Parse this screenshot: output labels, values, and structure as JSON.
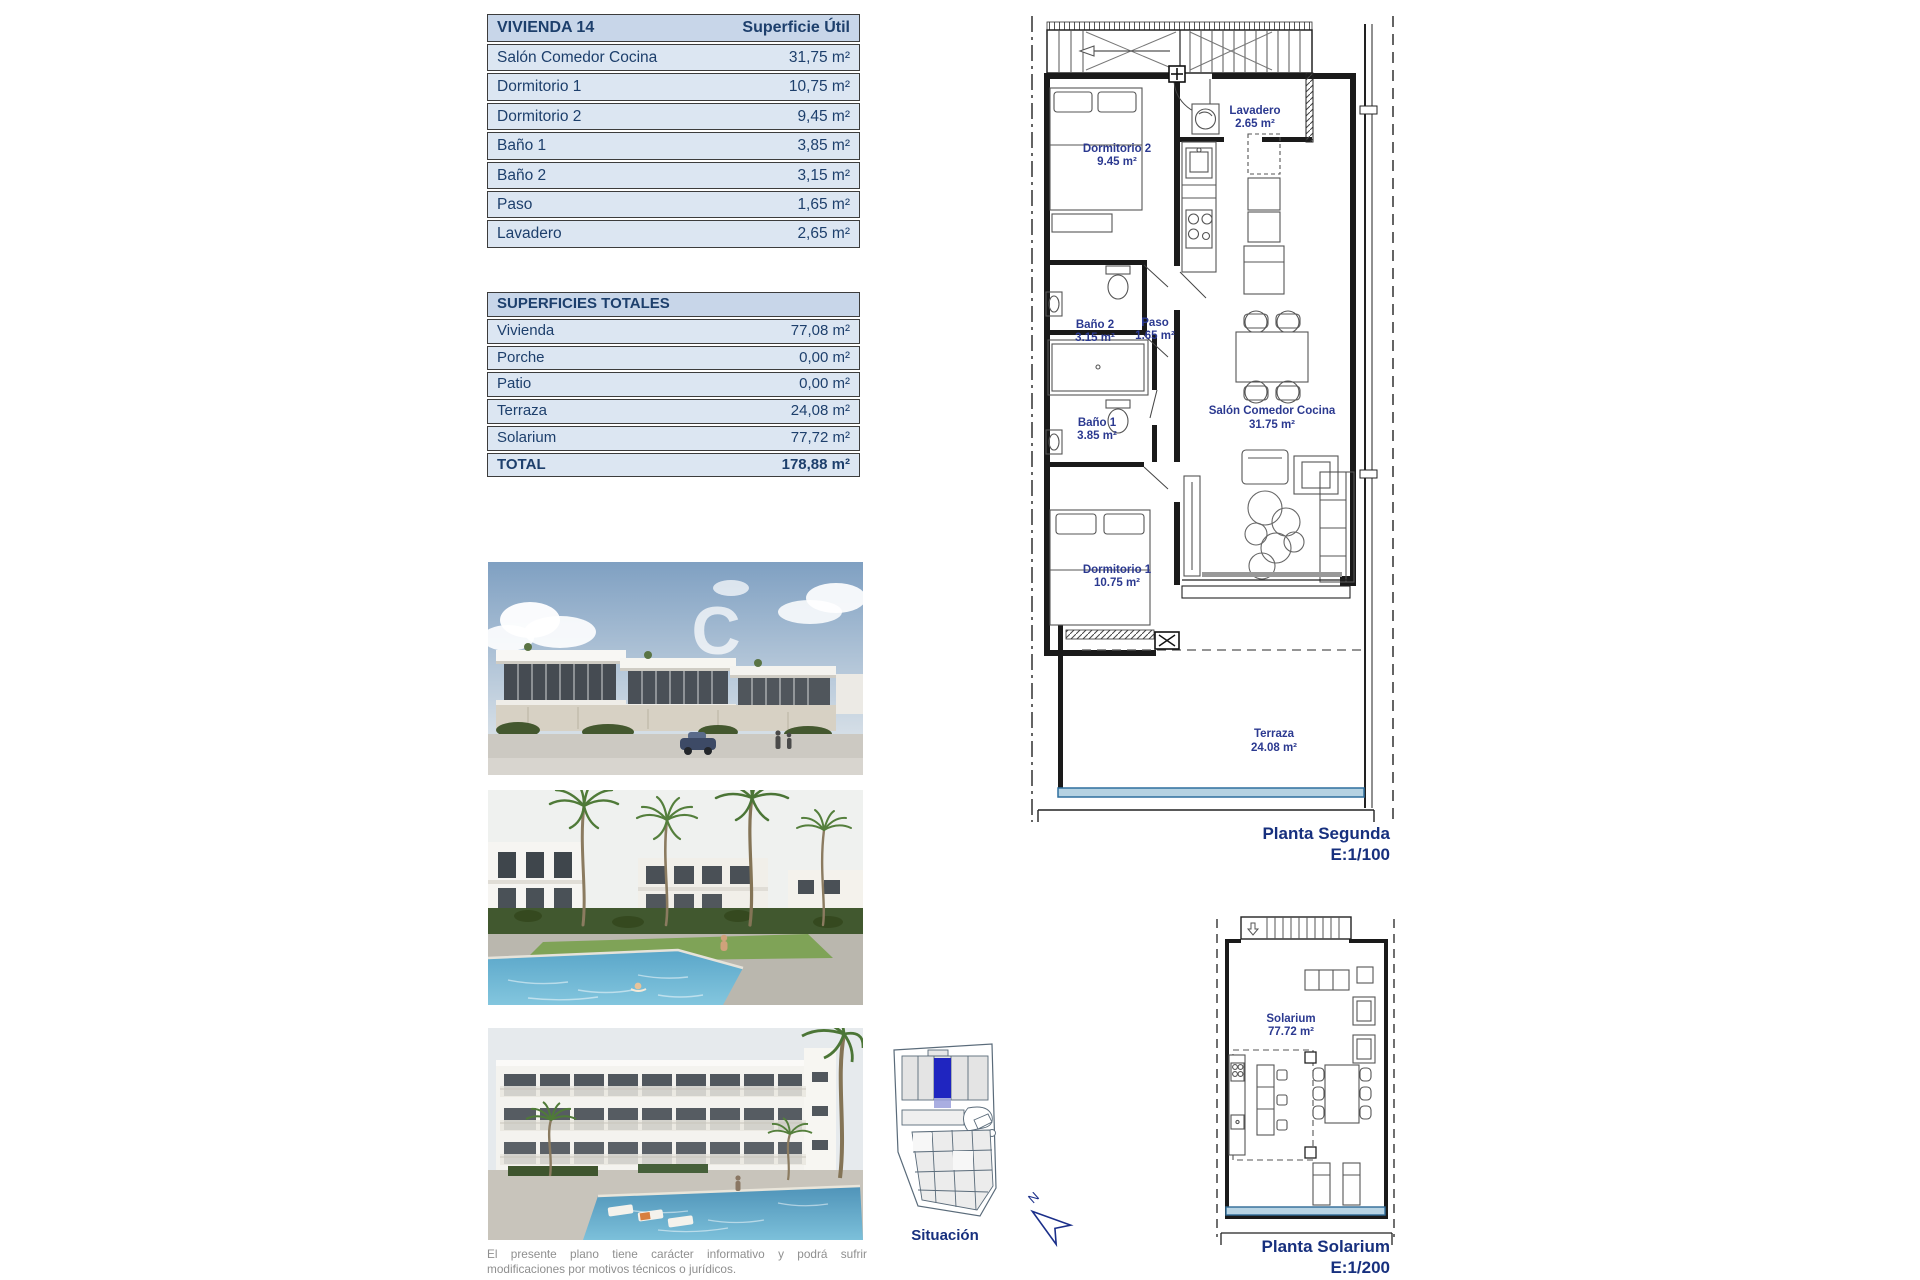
{
  "unit_table": {
    "title": "VIVIENDA 14",
    "header_right": "Superficie Útil",
    "rows": [
      {
        "label": "Salón Comedor Cocina",
        "value": "31,75 m²"
      },
      {
        "label": "Dormitorio 1",
        "value": "10,75 m²"
      },
      {
        "label": "Dormitorio 2",
        "value": "9,45 m²"
      },
      {
        "label": "Baño 1",
        "value": "3,85 m²"
      },
      {
        "label": "Baño 2",
        "value": "3,15 m²"
      },
      {
        "label": "Paso",
        "value": "1,65 m²"
      },
      {
        "label": "Lavadero",
        "value": "2,65 m²"
      }
    ]
  },
  "totals_table": {
    "title": "SUPERFICIES TOTALES",
    "rows": [
      {
        "label": "Vivienda",
        "value": "77,08 m²"
      },
      {
        "label": "Porche",
        "value": "0,00 m²"
      },
      {
        "label": "Patio",
        "value": "0,00 m²"
      },
      {
        "label": "Terraza",
        "value": "24,08 m²"
      },
      {
        "label": "Solarium",
        "value": "77,72 m²"
      }
    ],
    "total": {
      "label": "TOTAL",
      "value": "178,88 m²"
    }
  },
  "plans": {
    "segunda": {
      "caption_line1": "Planta Segunda",
      "caption_line2": "E:1/100",
      "rooms": [
        {
          "name": "Lavadero",
          "area": "2.65 m²"
        },
        {
          "name": "Dormitorio 2",
          "area": "9.45 m²"
        },
        {
          "name": "Baño 2",
          "area": "3.15 m²"
        },
        {
          "name": "Paso",
          "area": "1.65 m²"
        },
        {
          "name": "Baño 1",
          "area": "3.85 m²"
        },
        {
          "name": "Dormitorio 1",
          "area": "10.75 m²"
        },
        {
          "name": "Salón Comedor Cocina",
          "area": "31.75 m²"
        },
        {
          "name": "Terraza",
          "area": "24.08 m²"
        }
      ]
    },
    "solarium": {
      "caption_line1": "Planta Solarium",
      "caption_line2": "E:1/200",
      "rooms": [
        {
          "name": "Solarium",
          "area": "77.72 m²"
        }
      ]
    }
  },
  "situacion": {
    "label": "Situación",
    "north_label": "N"
  },
  "watermark": "C",
  "disclaimer": {
    "line1": "El presente plano tiene carácter informativo y podrá sufrir",
    "line2": "modificaciones por motivos técnicos o jurídicos."
  },
  "colors": {
    "table_text": "#1d3f6c",
    "table_header_bg": "#c8d6e9",
    "table_row_bg": "#dce6f2",
    "plan_label_text": "#2b3990",
    "caption_text": "#17307e",
    "highlight_plot_blue": "#1f25c0",
    "terrace_rail_blue": "#b5d2e2"
  }
}
